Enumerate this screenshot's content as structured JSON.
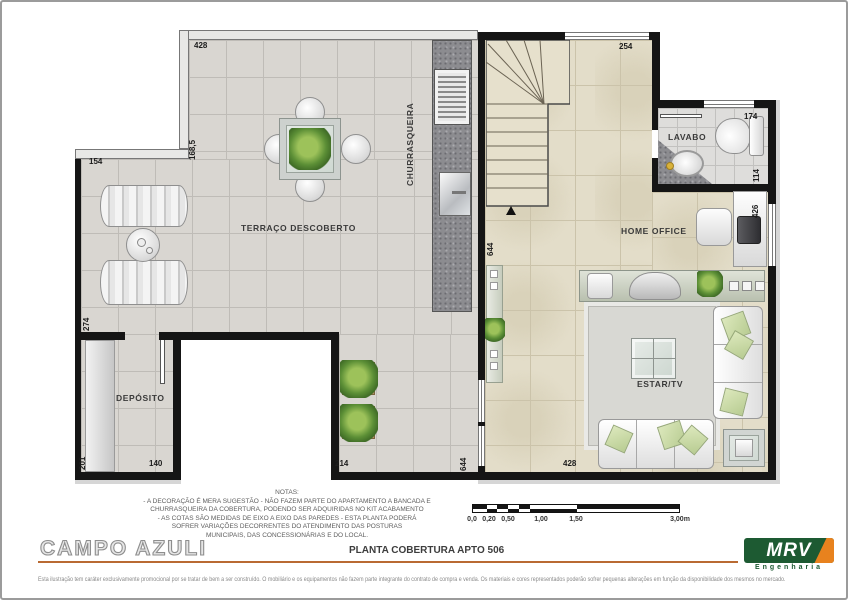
{
  "page": {
    "title": "CAMPO AZULI",
    "drawing_title": "PLANTA COBERTURA APTO 506",
    "disclaimer": "Esta ilustração tem caráter exclusivamente promocional por se tratar de bem a ser construído. O mobiliário e os equipamentos não fazem parte integrante do contrato de compra e venda. Os materiais e cores representados poderão sofrer pequenas alterações em função da disponibilidade dos mesmos no mercado."
  },
  "brand": {
    "name": "MRV",
    "tagline": "Engenharia",
    "green": "#1d5a32",
    "orange": "#e8821e"
  },
  "rooms": {
    "terraco": "TERRAÇO DESCOBERTO",
    "churrasqueira": "CHURRASQUEIRA",
    "deposito": "DEPÓSITO",
    "lavabo": "LAVABO",
    "home_office": "HOME OFFICE",
    "estar": "ESTAR/TV"
  },
  "dims": {
    "top_428": "428",
    "esq_168": "168,5",
    "esq_154": "154",
    "esq_274": "274",
    "esq_201": "201",
    "dep_140": "140",
    "ter_214": "214",
    "porta_644": "644",
    "fundo_428": "428",
    "escada_644": "644",
    "topo_254": "254",
    "lav_174": "174",
    "lav_114": "114",
    "dir_426": "426"
  },
  "notes": {
    "title": "NOTAS:",
    "line1": "- A DECORAÇÃO É MERA SUGESTÃO - NÃO FAZEM PARTE DO APARTAMENTO A BANCADA E",
    "line2": "CHURRASQUEIRA DA COBERTURA, PODENDO SER ADQUIRIDAS NO KIT ACABAMENTO",
    "line3": "- AS COTAS SÃO MEDIDAS DE EIXO A EIXO DAS PAREDES - ESTA PLANTA  PODERÁ",
    "line4": "SOFRER VARIAÇÕES DECORRENTES DO ATENDIMENTO DAS POSTURAS",
    "line5": "MUNICIPAIS, DAS CONCESSIONÁRIAS E DO LOCAL."
  },
  "scale": {
    "s0": "0,0",
    "s020": "0,20",
    "s050": "0,50",
    "s100": "1,00",
    "s150": "1,50",
    "s300": "3,00m"
  }
}
